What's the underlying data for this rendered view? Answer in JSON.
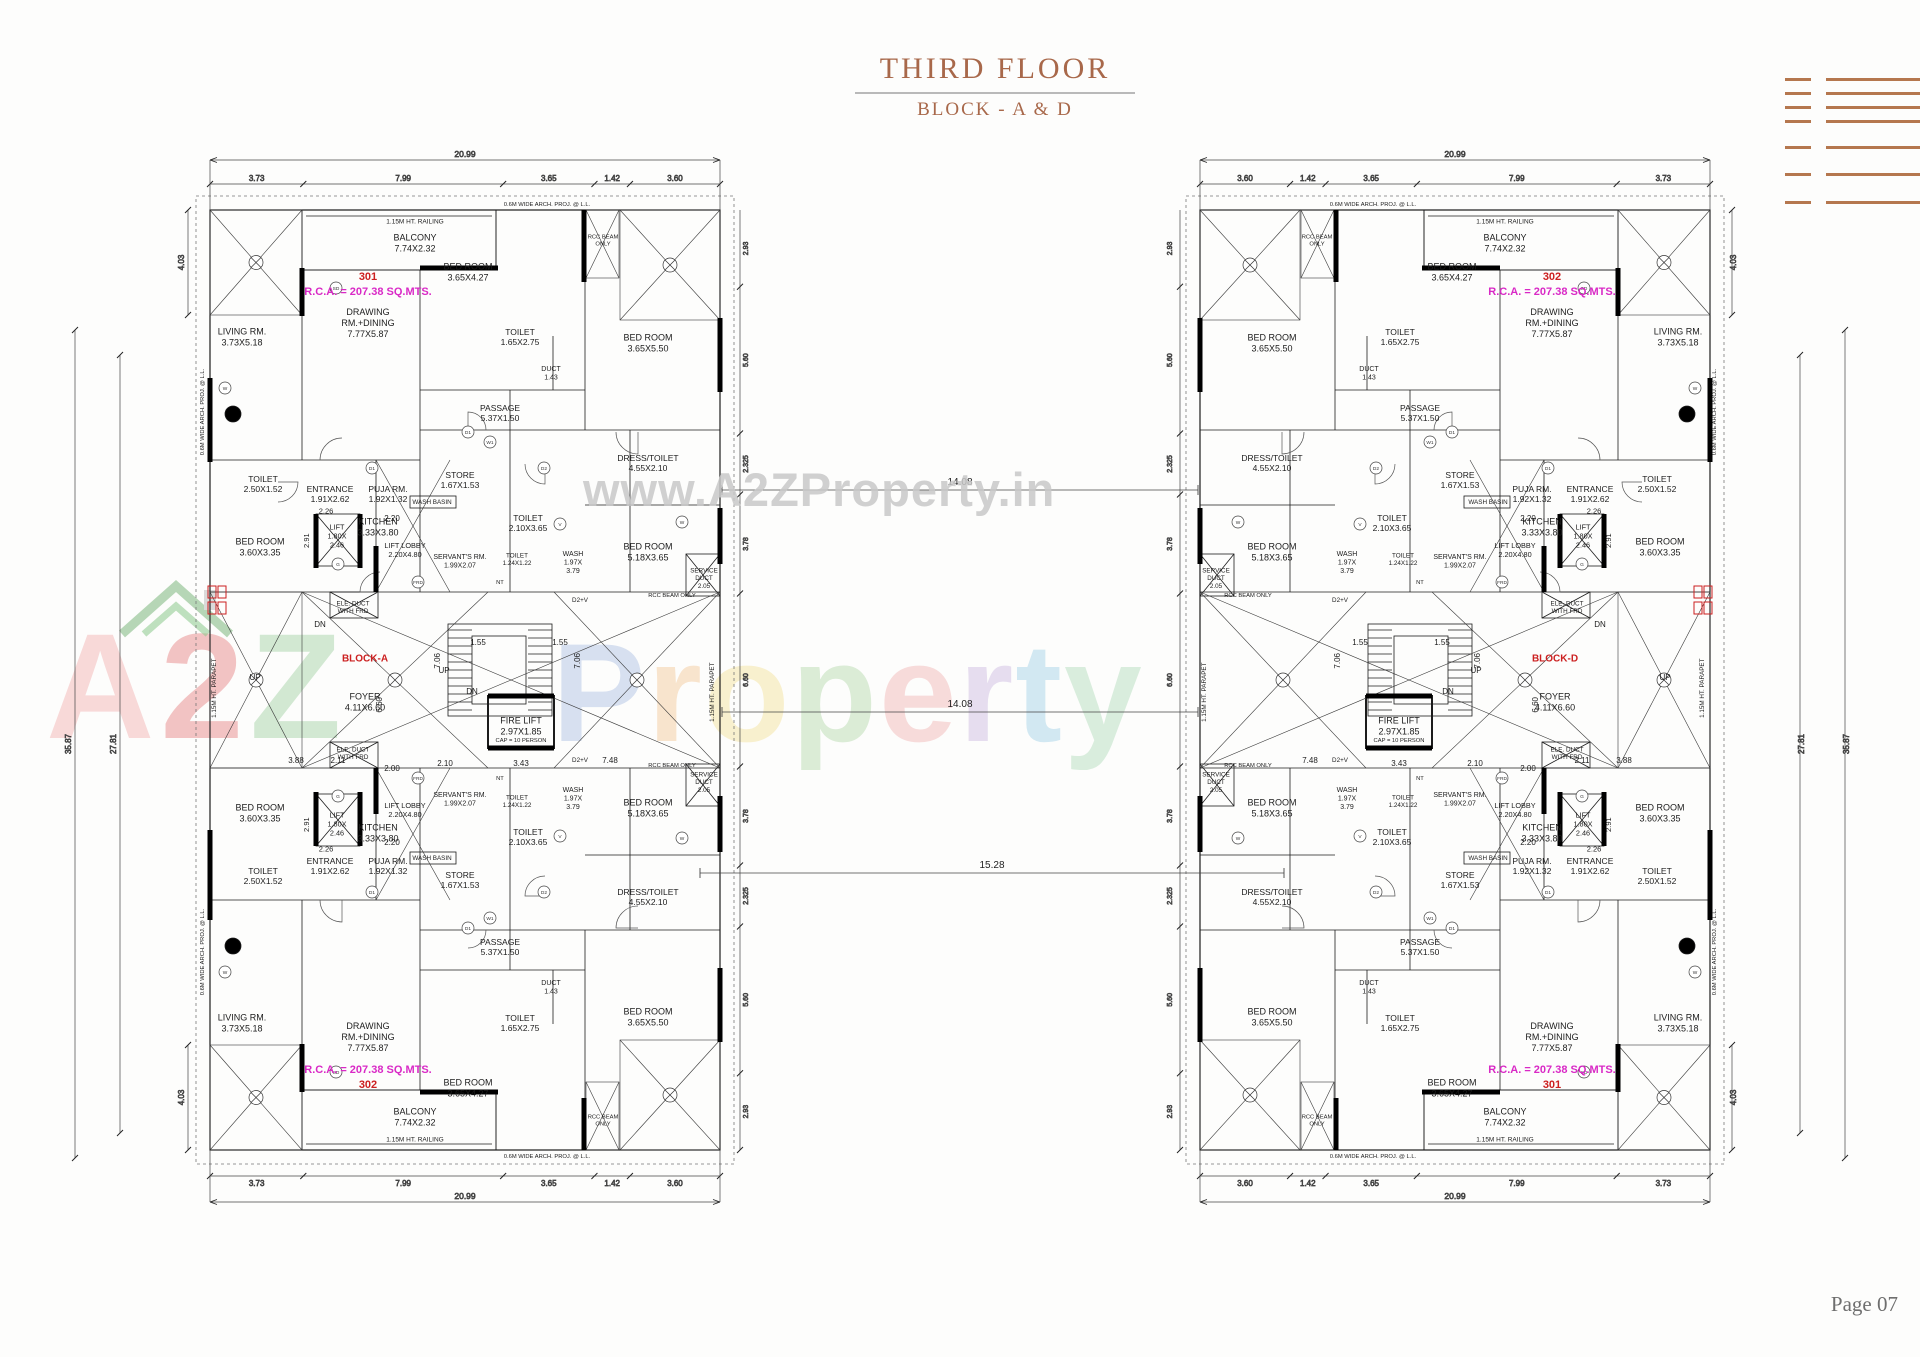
{
  "page": {
    "title": "THIRD FLOOR",
    "subtitle": "BLOCK - A & D",
    "page_no": "Page 07"
  },
  "watermark": {
    "url": "www.A2ZProperty.in",
    "brand": [
      {
        "ch": "A",
        "c": "#f2aeae"
      },
      {
        "ch": "2",
        "c": "#e57f7f"
      },
      {
        "ch": "Z",
        "c": "#9fd0a0"
      }
    ],
    "word": [
      {
        "ch": "P",
        "c": "#9fb6df"
      },
      {
        "ch": "r",
        "c": "#f3c089"
      },
      {
        "ch": "o",
        "c": "#f3de8a"
      },
      {
        "ch": "p",
        "c": "#a9d3a0"
      },
      {
        "ch": "e",
        "c": "#f0a9a9"
      },
      {
        "ch": "r",
        "c": "#c4aede"
      },
      {
        "ch": "t",
        "c": "#93cbe4"
      },
      {
        "ch": "y",
        "c": "#a5d6b0"
      }
    ]
  },
  "colors": {
    "red": "#cc2020",
    "mag": "#d929c6",
    "ink": "#1c1c1c",
    "brown": "#a8684a",
    "logo": "#b5774e"
  },
  "blocks": [
    {
      "id": "block-a",
      "label": "BLOCK-A",
      "mirror": false,
      "unit_top": {
        "no": "301",
        "rca": "R.C.A. = 207.38 SQ.MTS."
      },
      "unit_bottom": {
        "no": "302",
        "rca": "R.C.A. = 207.38 SQ.MTS."
      }
    },
    {
      "id": "block-d",
      "label": "BLOCK-D",
      "mirror": true,
      "unit_top": {
        "no": "302",
        "rca": "R.C.A. = 207.38 SQ.MTS."
      },
      "unit_bottom": {
        "no": "301",
        "rca": "R.C.A. = 207.38 SQ.MTS."
      }
    }
  ],
  "plan": {
    "dims": {
      "total_w": "20.99",
      "chain_w": [
        "3.73",
        "7.99",
        "3.65",
        "1.42",
        "3.60"
      ],
      "total_h": "35.87",
      "inner_h": "27.81",
      "corner_h": "4.03",
      "side_chain": [
        "2.93",
        "5.60",
        "2.325",
        "3.78",
        "6.60",
        "3.78",
        "2.325",
        "5.60",
        "2.93"
      ]
    },
    "labels": [
      {
        "id": "railing-top",
        "x": 395,
        "y": 91,
        "s": 6.5,
        "m": 1,
        "lines": [
          "1.15M HT. RAILING"
        ]
      },
      {
        "id": "balcony",
        "x": 395,
        "y": 113,
        "s": 9,
        "m": 1,
        "lines": [
          "BALCONY",
          "7.74X2.32"
        ]
      },
      {
        "id": "unit-no",
        "x": 348,
        "y": 146,
        "s": 11,
        "c": "red",
        "m": 1,
        "b": "no",
        "lines": []
      },
      {
        "id": "unit-rca",
        "x": 348,
        "y": 161,
        "s": 11,
        "c": "mag",
        "m": 1,
        "b": "rca",
        "lines": []
      },
      {
        "id": "drawing-rm",
        "x": 348,
        "y": 193,
        "s": 9,
        "m": 1,
        "lines": [
          "DRAWING",
          "RM.+DINING",
          "7.77X5.87"
        ]
      },
      {
        "id": "living-rm",
        "x": 222,
        "y": 207,
        "s": 9,
        "m": 1,
        "lines": [
          "LIVING RM.",
          "3.73X5.18"
        ]
      },
      {
        "id": "bed-room-1",
        "x": 448,
        "y": 142,
        "s": 9,
        "m": 1,
        "lines": [
          "BED ROOM",
          "3.65X4.27"
        ]
      },
      {
        "id": "toilet-1",
        "x": 500,
        "y": 207,
        "s": 8.5,
        "m": 1,
        "lines": [
          "TOILET",
          "1.65X2.75"
        ]
      },
      {
        "id": "bed-room-2",
        "x": 628,
        "y": 213,
        "s": 9,
        "m": 1,
        "lines": [
          "BED ROOM",
          "3.65X5.50"
        ]
      },
      {
        "id": "duct-143",
        "x": 531,
        "y": 243,
        "s": 7,
        "m": 1,
        "lines": [
          "DUCT",
          "1.43"
        ]
      },
      {
        "id": "passage",
        "x": 480,
        "y": 283,
        "s": 8.5,
        "m": 1,
        "lines": [
          "PASSAGE",
          "5.37X1.50"
        ]
      },
      {
        "id": "store",
        "x": 440,
        "y": 350,
        "s": 8.5,
        "m": 1,
        "lines": [
          "STORE",
          "1.67X1.53"
        ]
      },
      {
        "id": "wash-basin",
        "x": 412,
        "y": 372,
        "s": 6.3,
        "m": 1,
        "lines": [
          "WASH BASIN"
        ]
      },
      {
        "id": "kitchen",
        "x": 358,
        "y": 397,
        "s": 9,
        "m": 1,
        "lines": [
          "KITCHEN",
          "3.33X3.80"
        ]
      },
      {
        "id": "toilet-2",
        "x": 508,
        "y": 393,
        "s": 8.5,
        "m": 1,
        "lines": [
          "TOILET",
          "2.10X3.65"
        ]
      },
      {
        "id": "dress-toilet",
        "x": 628,
        "y": 333,
        "s": 8.5,
        "m": 1,
        "lines": [
          "DRESS/TOILET",
          "4.55X2.10"
        ]
      },
      {
        "id": "bed-room-3",
        "x": 628,
        "y": 422,
        "s": 9,
        "m": 1,
        "lines": [
          "BED ROOM",
          "5.18X3.65"
        ]
      },
      {
        "id": "wash",
        "x": 553,
        "y": 432,
        "s": 7,
        "m": 1,
        "lines": [
          "WASH",
          "1.97X",
          "3.79"
        ]
      },
      {
        "id": "toilet-3",
        "x": 497,
        "y": 429,
        "s": 6.3,
        "m": 1,
        "lines": [
          "TOILET",
          "1.24X1.22"
        ]
      },
      {
        "id": "service-duct",
        "x": 684,
        "y": 448,
        "s": 6.3,
        "m": 1,
        "lines": [
          "SERVICE",
          "DUCT",
          "2.05"
        ]
      },
      {
        "id": "servant-rm",
        "x": 440,
        "y": 431,
        "s": 7,
        "m": 1,
        "lines": [
          "SERVANT'S RM.",
          "1.99X2.07"
        ]
      },
      {
        "id": "entrance",
        "x": 310,
        "y": 364,
        "s": 8.5,
        "m": 1,
        "lines": [
          "ENTRANCE",
          "1.91X2.62"
        ]
      },
      {
        "id": "puja-rm",
        "x": 368,
        "y": 364,
        "s": 8.5,
        "m": 1,
        "lines": [
          "PUJA RM.",
          "1.92X1.32"
        ]
      },
      {
        "id": "dim-220",
        "x": 372,
        "y": 388,
        "s": 8,
        "m": 1,
        "lines": [
          "2.20"
        ]
      },
      {
        "id": "toilet-4",
        "x": 243,
        "y": 354,
        "s": 8.5,
        "m": 1,
        "lines": [
          "TOILET",
          "2.50X1.52"
        ]
      },
      {
        "id": "bed-room-4",
        "x": 240,
        "y": 417,
        "s": 9,
        "m": 1,
        "lines": [
          "BED ROOM",
          "3.60X3.35"
        ]
      },
      {
        "id": "lift",
        "x": 317,
        "y": 406,
        "s": 7.3,
        "m": 1,
        "lines": [
          "LIFT",
          "1.80X",
          "2.46"
        ]
      },
      {
        "id": "lift-lobby",
        "x": 385,
        "y": 420,
        "s": 7.3,
        "m": 1,
        "lines": [
          "LIFT LOBBY",
          "2.20X4.80"
        ]
      },
      {
        "id": "dim-226",
        "x": 306,
        "y": 381,
        "s": 7.5,
        "m": 1,
        "lines": [
          "2.26"
        ]
      },
      {
        "id": "dim-291",
        "x": 289,
        "y": 408,
        "s": 7.5,
        "r": 1,
        "m": 1,
        "lines": [
          "2.91"
        ]
      },
      {
        "id": "d2v",
        "x": 560,
        "y": 470,
        "s": 6.3,
        "m": 1,
        "lines": [
          "D2+V"
        ]
      },
      {
        "id": "nt",
        "x": 480,
        "y": 452,
        "s": 5.8,
        "m": 1,
        "lines": [
          "NT"
        ]
      },
      {
        "id": "rcc-beam-top",
        "x": 583,
        "y": 110,
        "s": 5.8,
        "m": 1,
        "lines": [
          "RCC BEAM",
          "ONLY"
        ]
      },
      {
        "id": "rcc-beam-mid",
        "x": 652,
        "y": 465,
        "s": 5.8,
        "m": 1,
        "lines": [
          "RCC BEAM ONLY"
        ]
      },
      {
        "id": "arch-proj-left",
        "x": 184,
        "y": 280,
        "s": 5.8,
        "r": 1,
        "m": 1,
        "lines": [
          "0.6M WIDE ARCH. PROJ. @ L.L."
        ]
      },
      {
        "id": "arch-proj-top",
        "x": 527,
        "y": 74,
        "s": 5.8,
        "m": 1,
        "lines": [
          "0.6M WIDE ARCH. PROJ. @ L.L."
        ]
      },
      {
        "id": "ele-duct",
        "x": 333,
        "y": 477,
        "s": 6.3,
        "m": 1,
        "lines": [
          "ELE. DUCT",
          "WITH FRD"
        ]
      },
      {
        "id": "dn-left",
        "x": 300,
        "y": 494,
        "s": 8,
        "lines": [
          "DN"
        ]
      },
      {
        "id": "up-left",
        "x": 235,
        "y": 547,
        "s": 8,
        "lines": [
          "UP"
        ]
      },
      {
        "id": "up-center",
        "x": 424,
        "y": 540,
        "s": 8,
        "lines": [
          "UP"
        ]
      },
      {
        "id": "dn-center",
        "x": 452,
        "y": 561,
        "s": 8,
        "lines": [
          "DN"
        ]
      },
      {
        "id": "block-label",
        "x": 345,
        "y": 528,
        "s": 10,
        "c": "red",
        "b": "label",
        "lines": []
      },
      {
        "id": "foyer",
        "x": 345,
        "y": 572,
        "s": 9,
        "lines": [
          "FOYER",
          "4.11X6.60"
        ]
      },
      {
        "id": "fire-lift",
        "x": 501,
        "y": 596,
        "s": 9,
        "lines": [
          "FIRE LIFT",
          "2.97X1.85"
        ]
      },
      {
        "id": "fire-lift-cap",
        "x": 501,
        "y": 610,
        "s": 5.8,
        "lines": [
          "CAP = 10 PERSON"
        ]
      },
      {
        "id": "dim-211",
        "x": 318,
        "y": 630,
        "s": 8,
        "lines": [
          "2.11"
        ]
      },
      {
        "id": "dim-200",
        "x": 372,
        "y": 638,
        "s": 8,
        "lines": [
          "2.00"
        ]
      },
      {
        "id": "dim-210",
        "x": 425,
        "y": 633,
        "s": 8,
        "lines": [
          "2.10"
        ]
      },
      {
        "id": "dim-343",
        "x": 501,
        "y": 633,
        "s": 8,
        "lines": [
          "3.43"
        ]
      },
      {
        "id": "dim-748",
        "x": 590,
        "y": 630,
        "s": 8,
        "lines": [
          "7.48"
        ]
      },
      {
        "id": "dim-388",
        "x": 276,
        "y": 630,
        "s": 8,
        "lines": [
          "3.88"
        ]
      },
      {
        "id": "dim-155a",
        "x": 458,
        "y": 512,
        "s": 8,
        "lines": [
          "1.55"
        ]
      },
      {
        "id": "dim-155b",
        "x": 540,
        "y": 512,
        "s": 8,
        "lines": [
          "1.55"
        ]
      },
      {
        "id": "dim-706a",
        "x": 420,
        "y": 528,
        "s": 8,
        "r": 1,
        "lines": [
          "7.06"
        ]
      },
      {
        "id": "dim-706b",
        "x": 560,
        "y": 528,
        "s": 8,
        "r": 1,
        "lines": [
          "7.06"
        ]
      },
      {
        "id": "dim-660",
        "x": 362,
        "y": 572,
        "s": 8,
        "r": 1,
        "lines": [
          "6.60"
        ]
      },
      {
        "id": "parapet-right",
        "x": 694,
        "y": 560,
        "s": 6.3,
        "r": 1,
        "lines": [
          "1.15M HT. PARAPET"
        ]
      },
      {
        "id": "parapet-left",
        "x": 196,
        "y": 556,
        "s": 6.3,
        "r": 1,
        "lines": [
          "1.15M HT. PARAPET"
        ]
      }
    ],
    "symbols": [
      {
        "ch": "W",
        "x": 205,
        "y": 258
      },
      {
        "ch": "W1",
        "x": 470,
        "y": 312
      },
      {
        "ch": "D1",
        "x": 352,
        "y": 338
      },
      {
        "ch": "D2",
        "x": 524,
        "y": 338
      },
      {
        "ch": "V",
        "x": 540,
        "y": 394
      },
      {
        "ch": "FRD",
        "x": 398,
        "y": 452
      },
      {
        "ch": "SD",
        "x": 316,
        "y": 158
      },
      {
        "ch": "G",
        "x": 318,
        "y": 434
      },
      {
        "ch": "W",
        "x": 662,
        "y": 392
      },
      {
        "ch": "D1",
        "x": 448,
        "y": 302
      }
    ]
  },
  "connectors": [
    {
      "label": "14.08",
      "y": 490,
      "x0": 722,
      "x1": 1198
    },
    {
      "label": "14.08",
      "y": 712,
      "x0": 722,
      "x1": 1198
    },
    {
      "label": "15.28",
      "y": 873,
      "x0": 700,
      "x1": 1284
    }
  ]
}
